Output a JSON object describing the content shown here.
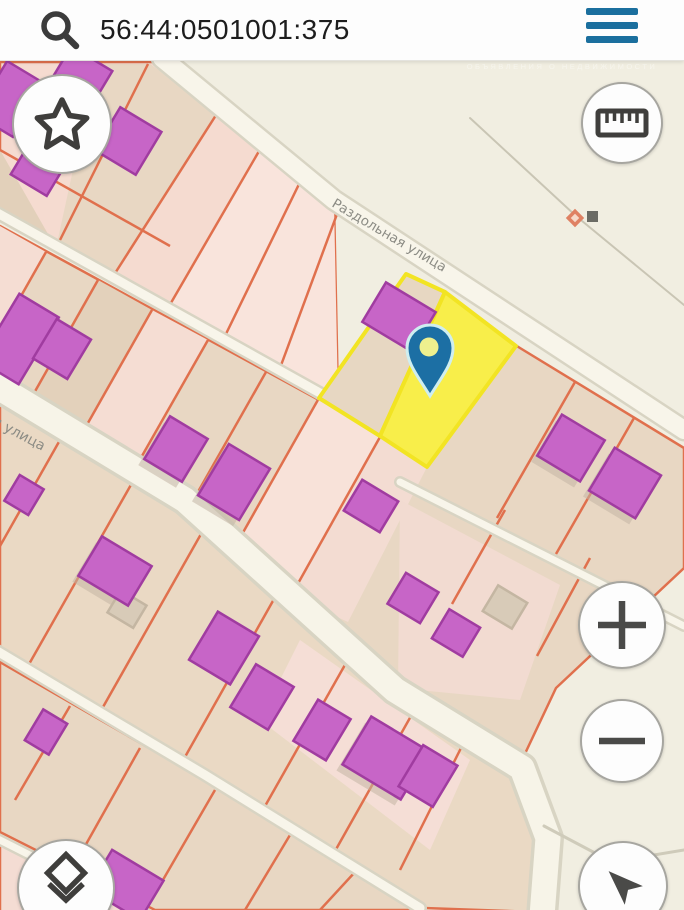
{
  "header": {
    "search_value": "56:44:0501001:375",
    "search_icon": "magnifier",
    "menu_icon": "hamburger"
  },
  "watermark": {
    "brand": "ONREALT",
    "tagline": "ОБЪЯВЛЕНИЯ О НЕДВИЖИМОСТИ"
  },
  "map": {
    "street_labels": {
      "diagonal": "Раздольная улица",
      "left_partial": "ая улица"
    },
    "selected_parcel": {
      "fill": "#f8ee4a",
      "border": "#f2e423",
      "pin_color": "#1c6fa4"
    },
    "legend_colors": {
      "parcel_border": "#e0704d",
      "parcel_pink": "#f5ddd3",
      "parcel_tan": "#e8d7c3",
      "building": "#c765c7",
      "road": "#f8f5ea",
      "background": "#f1eee1"
    },
    "poi_markers": [
      "orange-diamond",
      "gray-square"
    ],
    "controls": [
      {
        "name": "favorites",
        "icon": "star"
      },
      {
        "name": "measure",
        "icon": "ruler"
      },
      {
        "name": "zoom-in",
        "icon": "plus"
      },
      {
        "name": "zoom-out",
        "icon": "minus"
      },
      {
        "name": "layers",
        "icon": "layers"
      },
      {
        "name": "locate",
        "icon": "navigation-arrow"
      }
    ]
  }
}
